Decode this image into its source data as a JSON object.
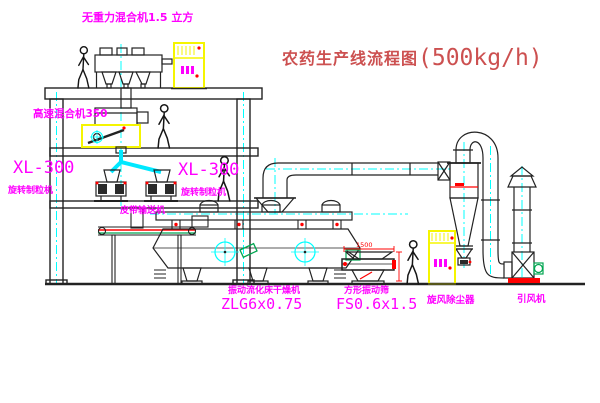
{
  "title": {
    "cn": "农药生产线流程图",
    "capacity": "(500kg/h)"
  },
  "labels": {
    "gravity_free_mixer": "无重力混合机1.5 立方",
    "high_speed_mixer": "高速混合机350",
    "granulator_left_model": "XL-300",
    "granulator_left_name": "旋转制粒机",
    "granulator_right_model": "XL-300",
    "granulator_right_name": "旋转制粒机",
    "belt_conveyor": "皮带输送机",
    "dryer_name": "振动流化床干燥机",
    "dryer_model": "ZLG6x0.75",
    "sieve_name": "方形振动筛",
    "sieve_model": "FS0.6x1.5",
    "cyclone": "旋风除尘器",
    "fan": "引风机",
    "sieve_dim": "1500"
  },
  "colors": {
    "background": "#ffffff",
    "label_magenta": "#ff00ff",
    "title_red": "#cc5050",
    "line_dark": "#222222",
    "centerline_cyan": "#00ffff",
    "highlight_yellow": "#f5f500",
    "detail_red": "#ff0000",
    "detail_green": "#00a550"
  }
}
